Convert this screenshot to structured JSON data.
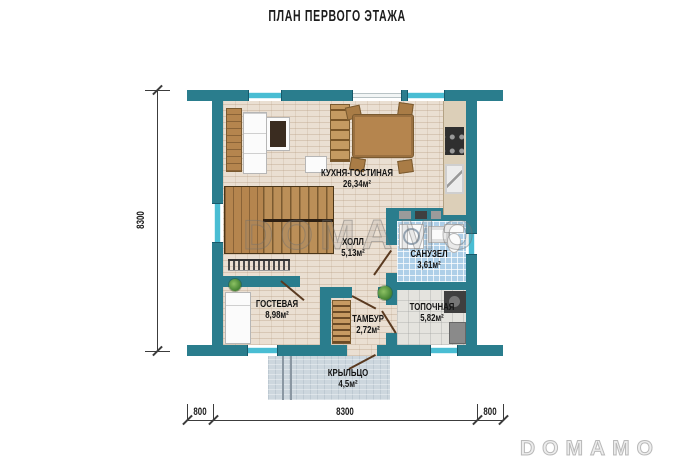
{
  "title": "ПЛАН ПЕРВОГО ЭТАЖА",
  "watermarks": {
    "center": "DOMAMO",
    "corner": "DOMAMO"
  },
  "rooms": [
    {
      "name": "КУХНЯ-ГОСТИНАЯ",
      "area": "26,34м²"
    },
    {
      "name": "ХОЛЛ",
      "area": "5,13м²"
    },
    {
      "name": "САНУЗЕЛ",
      "area": "3,61м²"
    },
    {
      "name": "ГОСТЕВАЯ",
      "area": "8,98м²"
    },
    {
      "name": "ТАМБУР",
      "area": "2,72м²"
    },
    {
      "name": "ТОПОЧНАЯ",
      "area": "5,82м²"
    },
    {
      "name": "КРЫЛЬЦО",
      "area": "4,5м²"
    }
  ],
  "dimensions": {
    "left": "8300",
    "bottom": [
      "800",
      "8300",
      "800"
    ]
  },
  "colors": {
    "wall": "#2a7d8d",
    "floor": "#eadfd2",
    "bath_tile": "#aecfe8",
    "wood": "#b5854e",
    "porch": "#cdd7de",
    "window": "#49bdd3"
  }
}
